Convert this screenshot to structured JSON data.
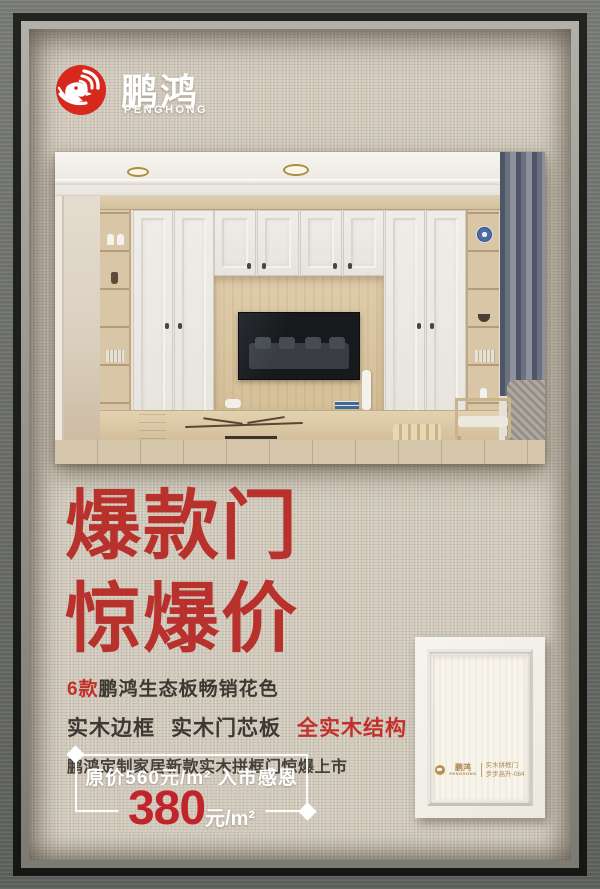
{
  "brand": {
    "name_cn": "鹏鸿",
    "name_en": "PENGHONG"
  },
  "headline": {
    "line1": "爆款门",
    "line2": "惊爆价"
  },
  "features": {
    "line1_highlight": "6款",
    "line1_rest": "鹏鸿生态板畅销花色",
    "line2_part1": "实木边框",
    "line2_part2": "实木门芯板",
    "line2_highlight": "全实木结构",
    "line3": "鹏鸿定制家居新款实木拼框门惊爆上市"
  },
  "price": {
    "original_label": "原价560元/m² 入市感恩价",
    "promo_value": "380",
    "promo_unit": "元/m²"
  },
  "door_sample": {
    "brand_cn": "鹏鸿",
    "brand_en": "PENGHONG",
    "product": "实木拼框门",
    "model": "步步高升-084"
  },
  "colors": {
    "brand_red": "#d7281e",
    "headline_red": "#b8312d",
    "price_red": "#c2242c",
    "linen_bg": "#d3ccbe",
    "frame_gray": "#6e706d",
    "label_gold": "#ad8a50"
  }
}
